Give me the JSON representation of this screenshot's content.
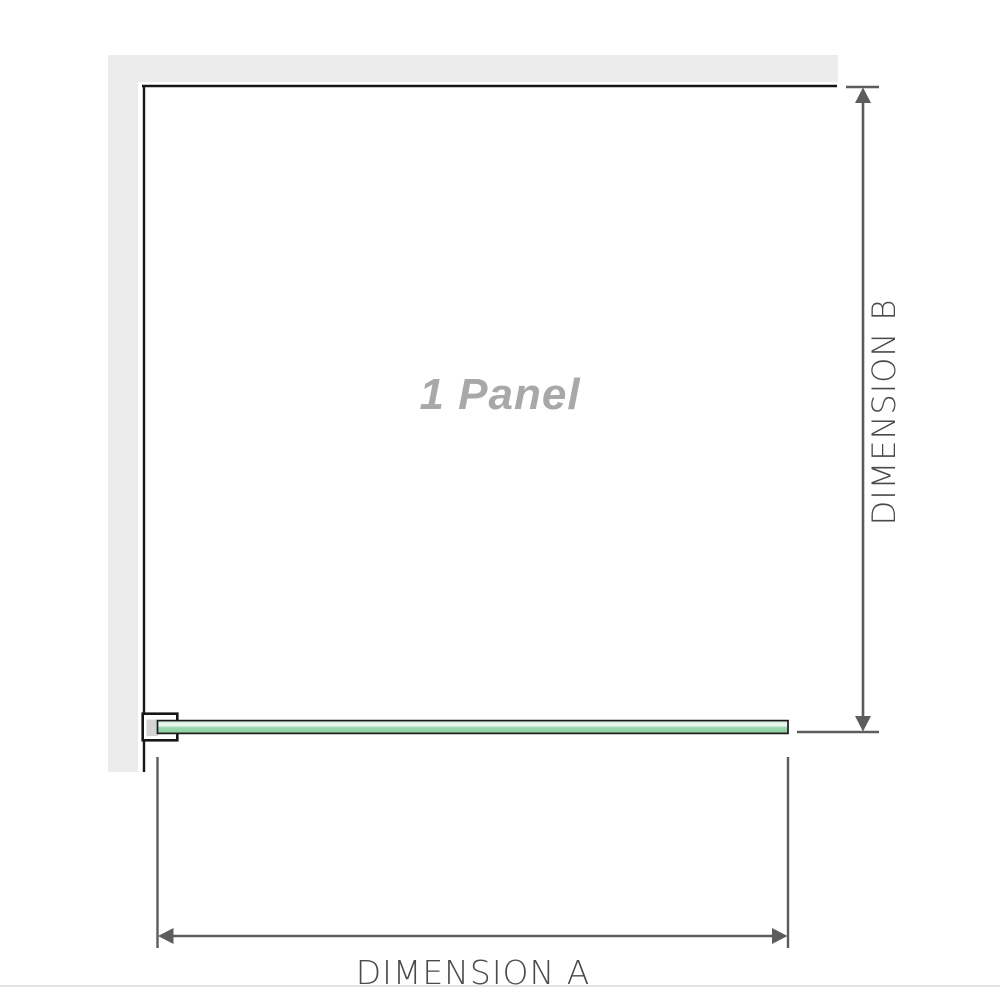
{
  "diagram": {
    "panel_label": "1 Panel",
    "dimension_a_label": "DIMENSION A",
    "dimension_b_label": "DIMENSION B"
  },
  "colors": {
    "background": "#ffffff",
    "wall": "#ececec",
    "outline": "#161616",
    "glass_border": "#1c1c1c",
    "glass_light": "#cdeeda",
    "glass_highlight": "#eef9f2",
    "glass_mid": "#9dd7b0",
    "glass_dark": "#8bcfa0",
    "bracket_fill": "#ffffff",
    "bracket_inner": "#d4d4d4",
    "dimension_line": "#5c5c5c",
    "label_text": "#4a4a4a",
    "panel_text": "#a8a8a8",
    "footer_line": "#e7e4df"
  }
}
